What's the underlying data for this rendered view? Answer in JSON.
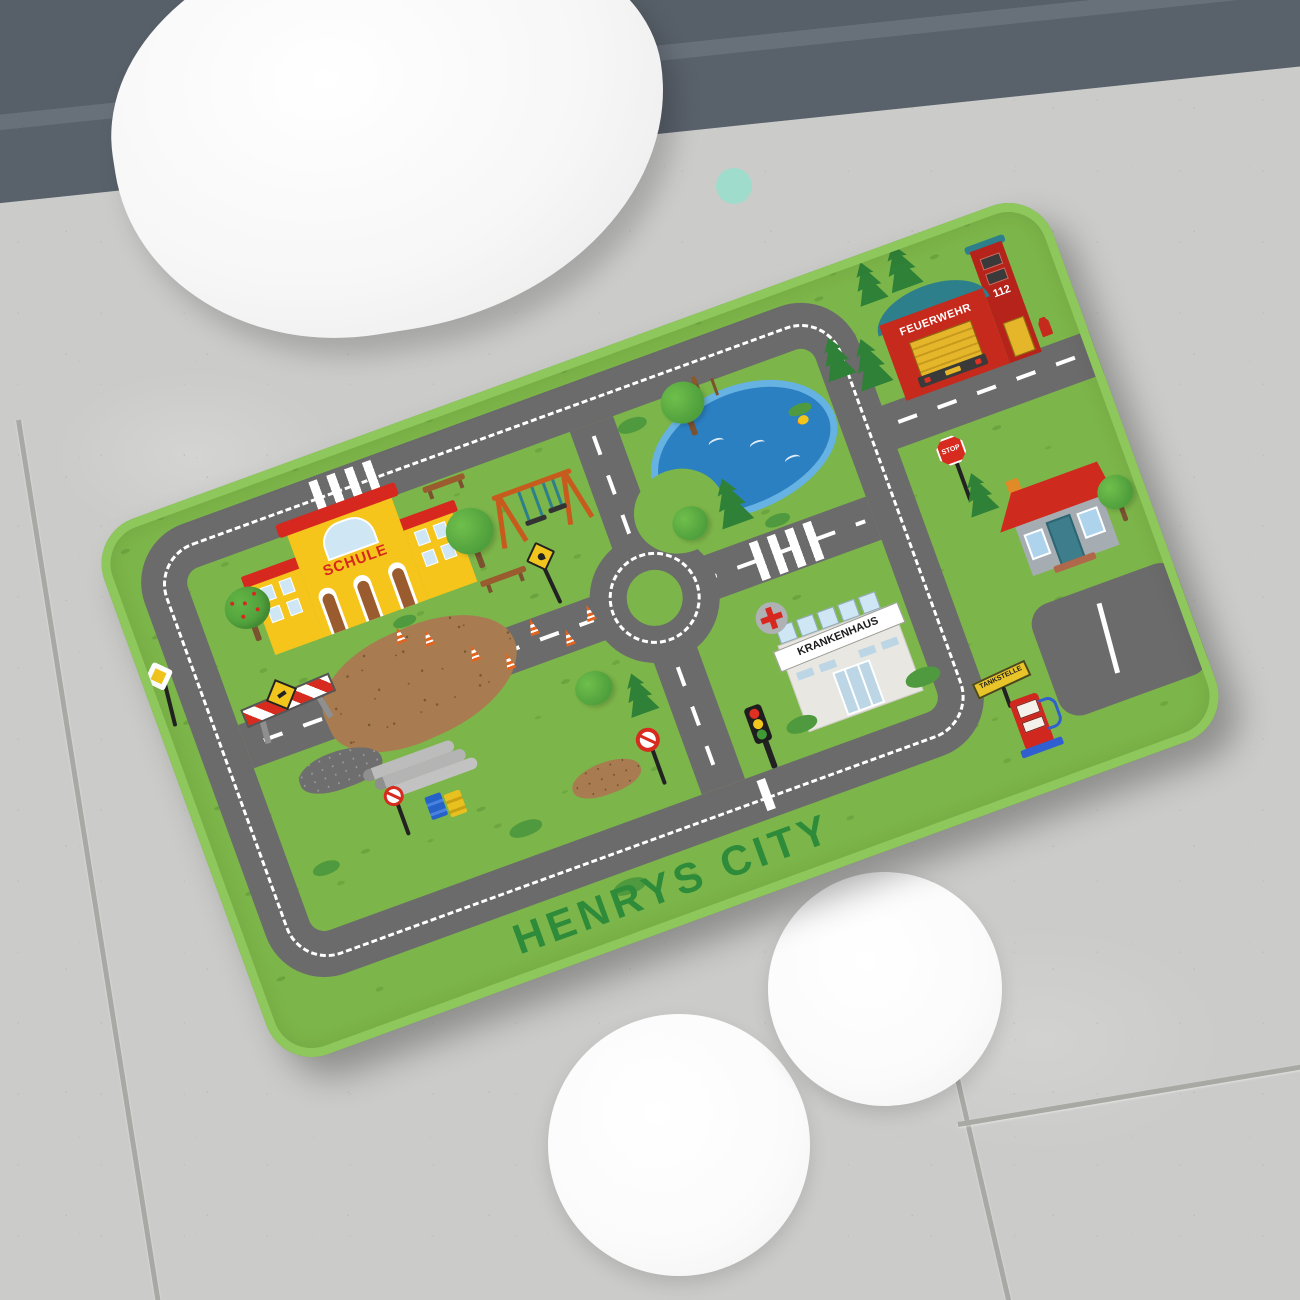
{
  "mat": {
    "title": "HENRYS CITY",
    "labels": {
      "school": "SCHULE",
      "fire_station": "FEUERWEHR",
      "emergency_number": "112",
      "hospital": "KRANKENHAUS",
      "gas_station": "TANKSTELLE",
      "stop_sign": "STOP"
    },
    "colors": {
      "mat_green": "#7cb549",
      "road_gray": "#6b6b6b",
      "title_green": "#2e8b3a",
      "school_yellow": "#f6c51b",
      "fire_red": "#c62a1c",
      "roof_red": "#d6281e",
      "pond_blue": "#2b80c2"
    }
  }
}
